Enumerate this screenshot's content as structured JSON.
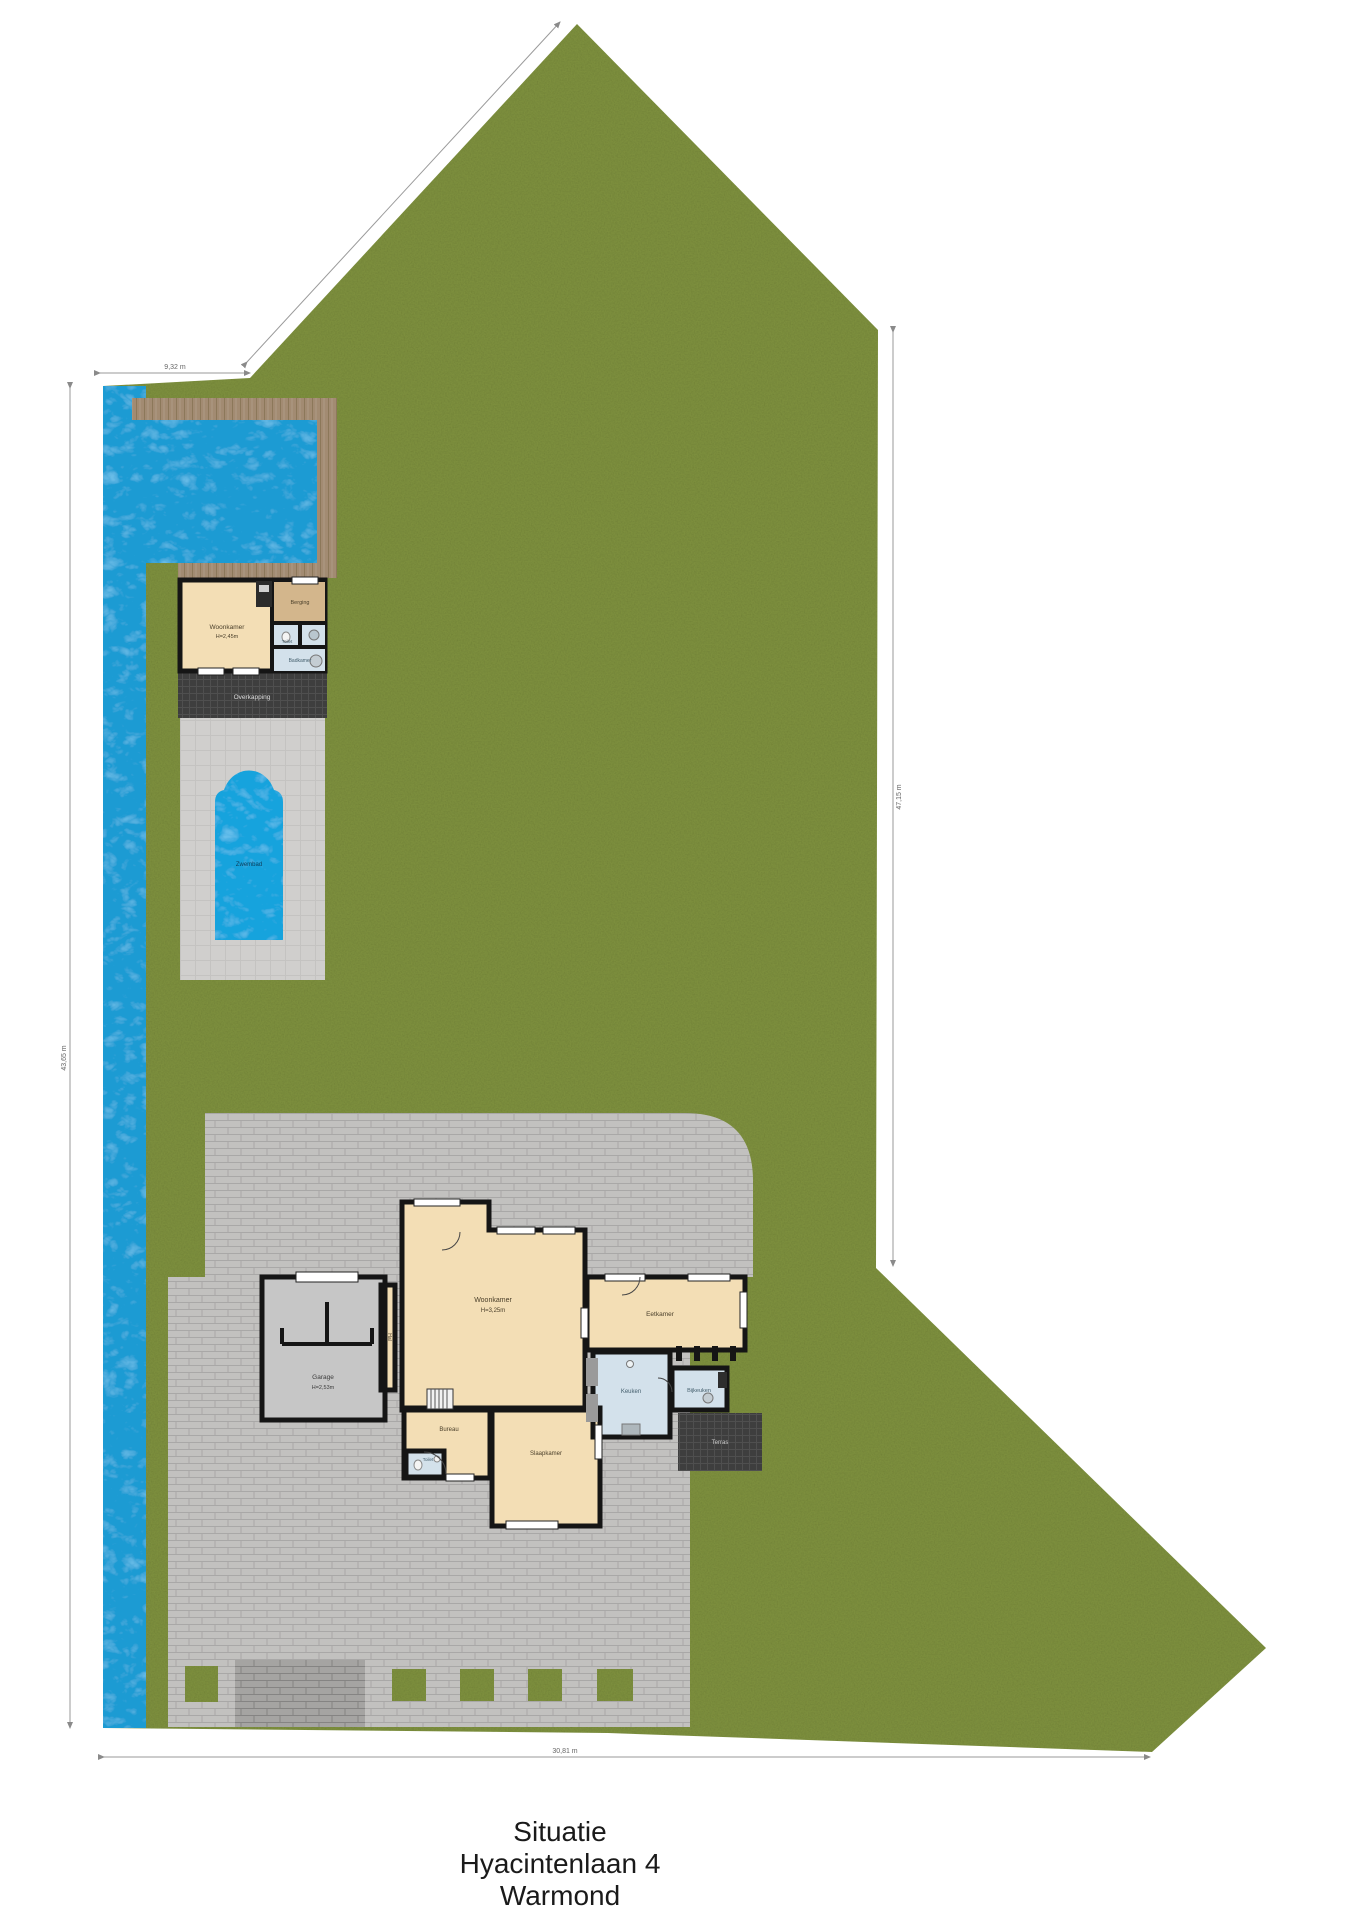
{
  "title": {
    "line1": "Situatie",
    "line2": "Hyacintenlaan 4",
    "line3": "Warmond"
  },
  "dimensions": {
    "top": "9,32 m",
    "bottom": "30,81 m",
    "left": "43,65 m",
    "right": "47,15 m"
  },
  "poolhouse": {
    "living": "Woonkamer",
    "living_sub": "H=2,45m",
    "storage": "Berging",
    "toilet": "Toilet",
    "bath": "Badkamer",
    "canopy": "Overkapping",
    "pool": "Zwembad"
  },
  "house": {
    "living": "Woonkamer",
    "living_sub": "H=3,25m",
    "dining": "Eetkamer",
    "kitchen": "Keuken",
    "utility": "Bijkeuken",
    "office": "Bureau",
    "bedroom": "Slaapkamer",
    "toilet": "Toilet",
    "garage": "Garage",
    "garage_sub": "H=2,53m",
    "hall": "Hal",
    "terrace": "Terras"
  },
  "colors": {
    "grass": "#7c8e3d",
    "water": "#1b9bd3",
    "deck_wood": "#a28b72",
    "paving": "#c9c8c6",
    "paving_dark": "#a9a8a6",
    "terrace_dark": "#3e3e3e",
    "room_beige": "#f3deb5",
    "room_tan": "#d3b68c",
    "room_blue": "#d3e1eb",
    "garage_gray": "#c6c6c6",
    "wall": "#151515"
  }
}
